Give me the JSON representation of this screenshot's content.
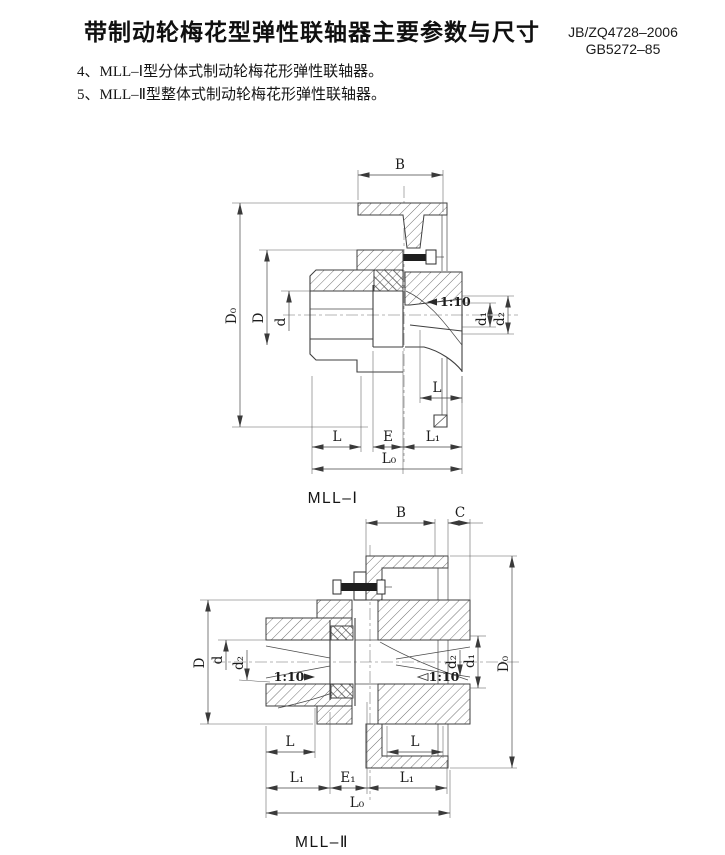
{
  "header": {
    "title": "带制动轮梅花型弹性联轴器主要参数与尺寸",
    "standard_codes": [
      "JB/ZQ4728–2006",
      "GB5272–85"
    ]
  },
  "notes": [
    "4、MLL–Ⅰ型分体式制动轮梅花形弹性联轴器。",
    "5、MLL–Ⅱ型整体式制动轮梅花形弹性联轴器。"
  ],
  "figures": [
    {
      "caption": "MLL–Ⅰ",
      "taper_label": "1:10",
      "dim_labels": {
        "B": "B",
        "D0": "D₀",
        "D": "D",
        "d": "d",
        "d1": "d₁",
        "d2": "d₂",
        "L": "L",
        "E": "E",
        "L1": "L₁",
        "L0": "L₀"
      }
    },
    {
      "caption": "MLL–Ⅱ",
      "taper_label": "1:10",
      "dim_labels": {
        "B": "B",
        "C": "C",
        "D0": "D₀",
        "D": "D",
        "d": "d",
        "d1": "d₁",
        "d2": "d₂",
        "L": "L",
        "E1": "E₁",
        "L1": "L₁",
        "L0": "L₀"
      }
    }
  ],
  "colors": {
    "paper": "#ffffff",
    "line": "#3f3f3f",
    "text": "#1c1c1c"
  }
}
